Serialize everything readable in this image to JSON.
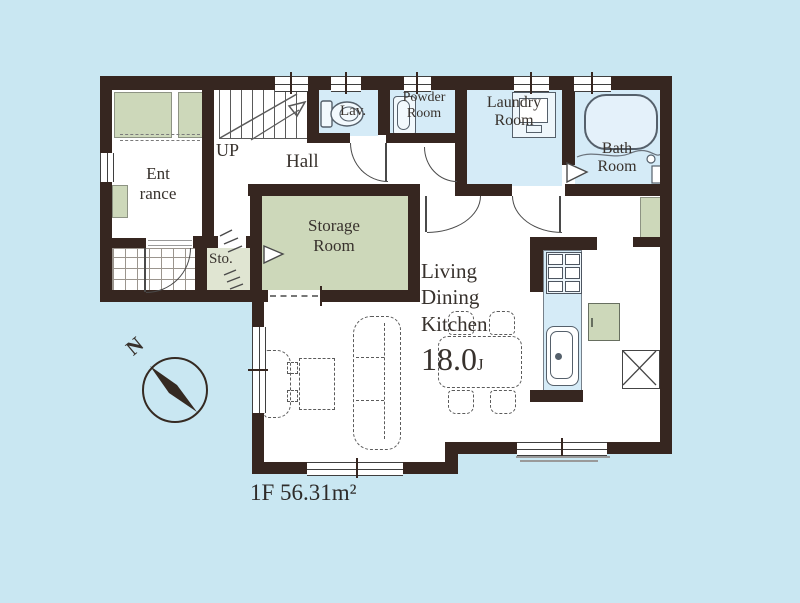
{
  "colors": {
    "background": "#c9e7f2",
    "wall": "#362620",
    "wet_area_floor": "#d5ebf7",
    "closet_area": "#cdd8ba",
    "sto_floor": "#e0e5d2",
    "room_floor": "#ffffff",
    "label_text": "#38322d"
  },
  "rooms": {
    "entrance": {
      "line1": "Ent",
      "line2": "rance"
    },
    "stairs": "UP",
    "hall": "Hall",
    "lavatory": "Lav.",
    "powder": {
      "line1": "Powder",
      "line2": "Room"
    },
    "laundry": {
      "line1": "Laundry",
      "line2": "Room"
    },
    "bath": {
      "line1": "Bath",
      "line2": "Room"
    },
    "storage": {
      "line1": "Storage",
      "line2": "Room"
    },
    "sto": "Sto.",
    "ldk": {
      "line1": "Living",
      "line2": "Dining",
      "line3": "Kitchen",
      "size": "18.0",
      "unit": "J"
    }
  },
  "compass": {
    "label": "N"
  },
  "floor_label": "1F 56.31m²",
  "icons": {
    "compass": "circle-with-needle",
    "toilet": "tank-and-bowl outline",
    "powder_sink": "rounded-basin outline",
    "washing_machine": "square with inner panel",
    "bathtub": "rounded rectangle",
    "stove": "2x3 burner grid",
    "kitchen_sink": "rounded basin with faucet dot",
    "refrigerator_space": "box with X",
    "sliding_door": "white triangle marker",
    "folding_door": "zigzag hatch"
  }
}
